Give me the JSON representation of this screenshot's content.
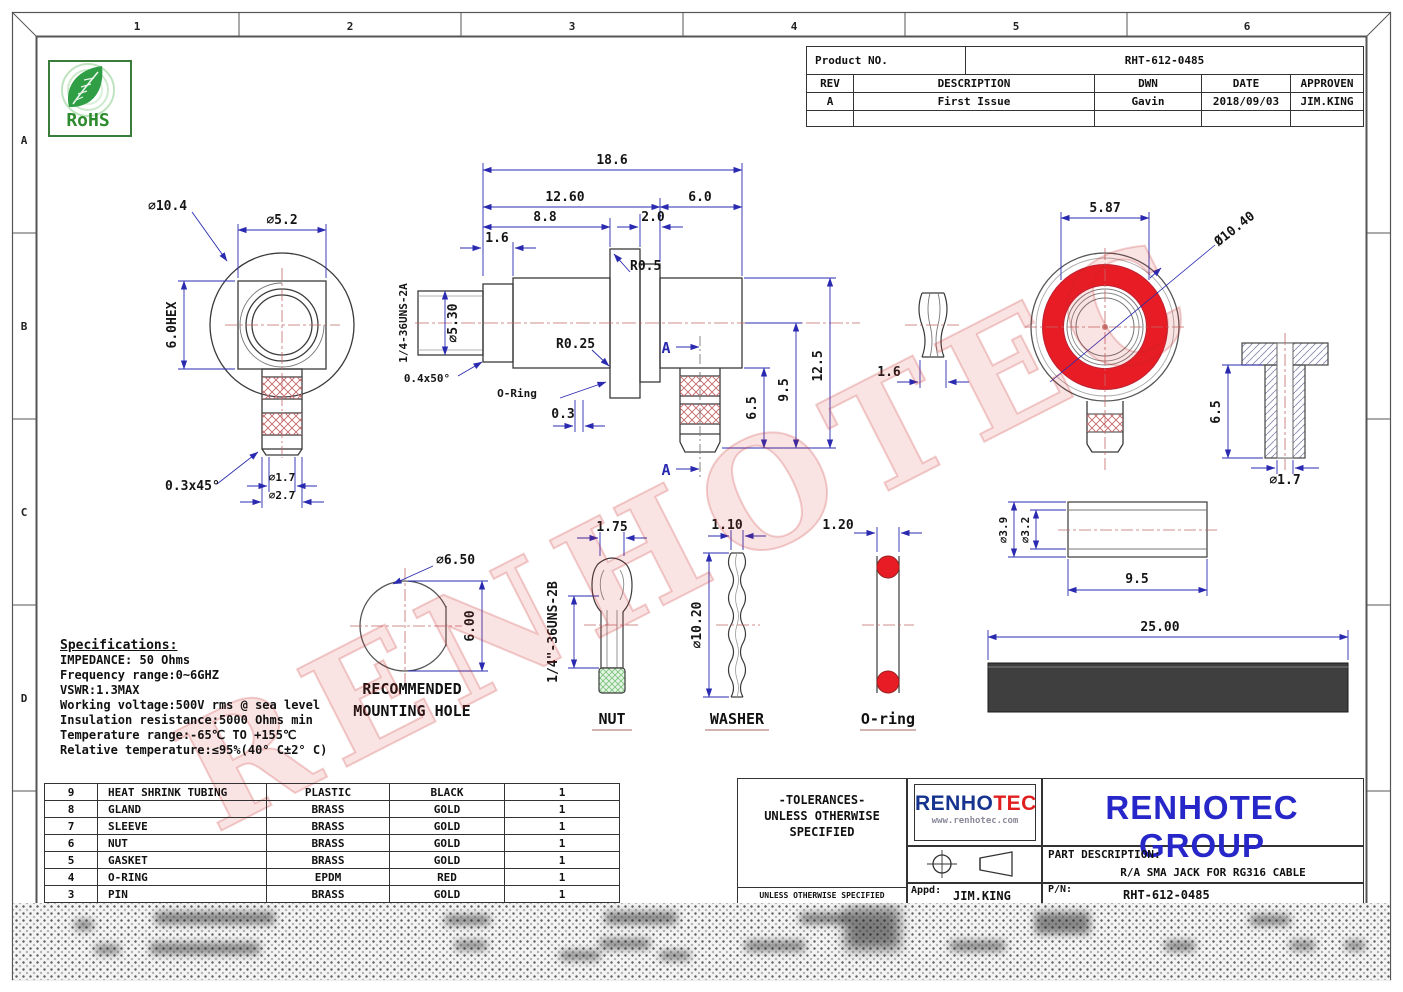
{
  "zones": {
    "top": [
      "1",
      "2",
      "3",
      "4",
      "5",
      "6"
    ],
    "left": [
      "A",
      "B",
      "C",
      "D"
    ]
  },
  "rohs_label": "RoHS",
  "product_table": {
    "product_no_label": "Product NO.",
    "product_no": "RHT-612-0485",
    "headers": [
      "REV",
      "DESCRIPTION",
      "DWN",
      "DATE",
      "APPROVEN"
    ],
    "row": [
      "A",
      "First Issue",
      "Gavin",
      "2018/09/03",
      "JIM.KING"
    ]
  },
  "dims": {
    "lv_d104": "⌀10.4",
    "lv_d52": "⌀5.2",
    "lv_hex": "6.0HEX",
    "lv_ch": "0.3x45°",
    "lv_d17": "⌀1.7",
    "lv_d27": "⌀2.7",
    "cv_total": "18.6",
    "cv_1260": "12.60",
    "cv_60": "6.0",
    "cv_88": "8.8",
    "cv_20": "2.0",
    "cv_16": "1.6",
    "cv_r05": "R0.5",
    "cv_d530": "⌀5.30",
    "cv_thread": "1/4-36UNS-2A",
    "cv_r025": "R0.25",
    "cv_ch": "0.4x50°",
    "cv_oring": "O-Ring",
    "cv_03": "0.3",
    "cv_65": "6.5",
    "cv_95": "9.5",
    "cv_125": "12.5",
    "gs_16": "1.6",
    "fv_587": "5.87",
    "fv_d1040": "Ø10.40",
    "tp_65": "6.5",
    "tp_d17": "⌀1.7",
    "mh_d650": "⌀6.50",
    "mh_600": "6.00",
    "nut_175": "1.75",
    "nut_thread": "1/4\"-36UNS-2B",
    "wa_110": "1.10",
    "wa_d1020": "⌀10.20",
    "or_120": "1.20",
    "sl_d39": "⌀3.9",
    "sl_d32": "⌀3.2",
    "sl_95": "9.5",
    "hs_2500": "25.00"
  },
  "view_labels": {
    "mounting_line1": "RECOMMENDED",
    "mounting_line2": "MOUNTING HOLE",
    "nut": "NUT",
    "washer": "WASHER",
    "oring": "O-ring",
    "section": "A"
  },
  "specs": {
    "title": "Specifications:",
    "lines": [
      "IMPEDANCE: 50 Ohms",
      "Frequency range:0~6GHZ",
      "VSWR:1.3MAX",
      "Working voltage:500V rms @ sea level",
      "Insulation resistance:5000 Ohms min",
      "Temperature range:-65℃ TO +155℃",
      "Relative temperature:≤95%(40° C±2° C)"
    ]
  },
  "parts_table": {
    "rows": [
      [
        "9",
        "HEAT SHRINK TUBING",
        "PLASTIC",
        "BLACK",
        "1"
      ],
      [
        "8",
        "GLAND",
        "BRASS",
        "GOLD",
        "1"
      ],
      [
        "7",
        "SLEEVE",
        "BRASS",
        "GOLD",
        "1"
      ],
      [
        "6",
        "NUT",
        "BRASS",
        "GOLD",
        "1"
      ],
      [
        "5",
        "GASKET",
        "BRASS",
        "GOLD",
        "1"
      ],
      [
        "4",
        "O-RING",
        "EPDM",
        "RED",
        "1"
      ],
      [
        "3",
        "PIN",
        "BRASS",
        "GOLD",
        "1"
      ]
    ]
  },
  "title_block": {
    "tolerances": [
      "-TOLERANCES-",
      "UNLESS OTHERWISE",
      "SPECIFIED"
    ],
    "small_note": "UNLESS OTHERWISE SPECIFIED",
    "logo_part1": "RENHO",
    "logo_part2": "TEC",
    "logo_url": "www.renhotec.com",
    "company": "RENHOTEC GROUP",
    "part_desc_label": "PART DESCRIPTION:",
    "part_desc": "R/A SMA JACK FOR RG316 CABLE",
    "appd_label": "Appd:",
    "appd": "JIM.KING",
    "pn_label": "P/N:",
    "pn": "RHT-612-0485"
  },
  "watermark": "RENHOTEC",
  "colors": {
    "accent_red": "#e81c24",
    "dim_blue": "#2a2ab0",
    "company_blue": "#2726c9",
    "logo_blue": "#16338e",
    "logo_red": "#e02020"
  }
}
